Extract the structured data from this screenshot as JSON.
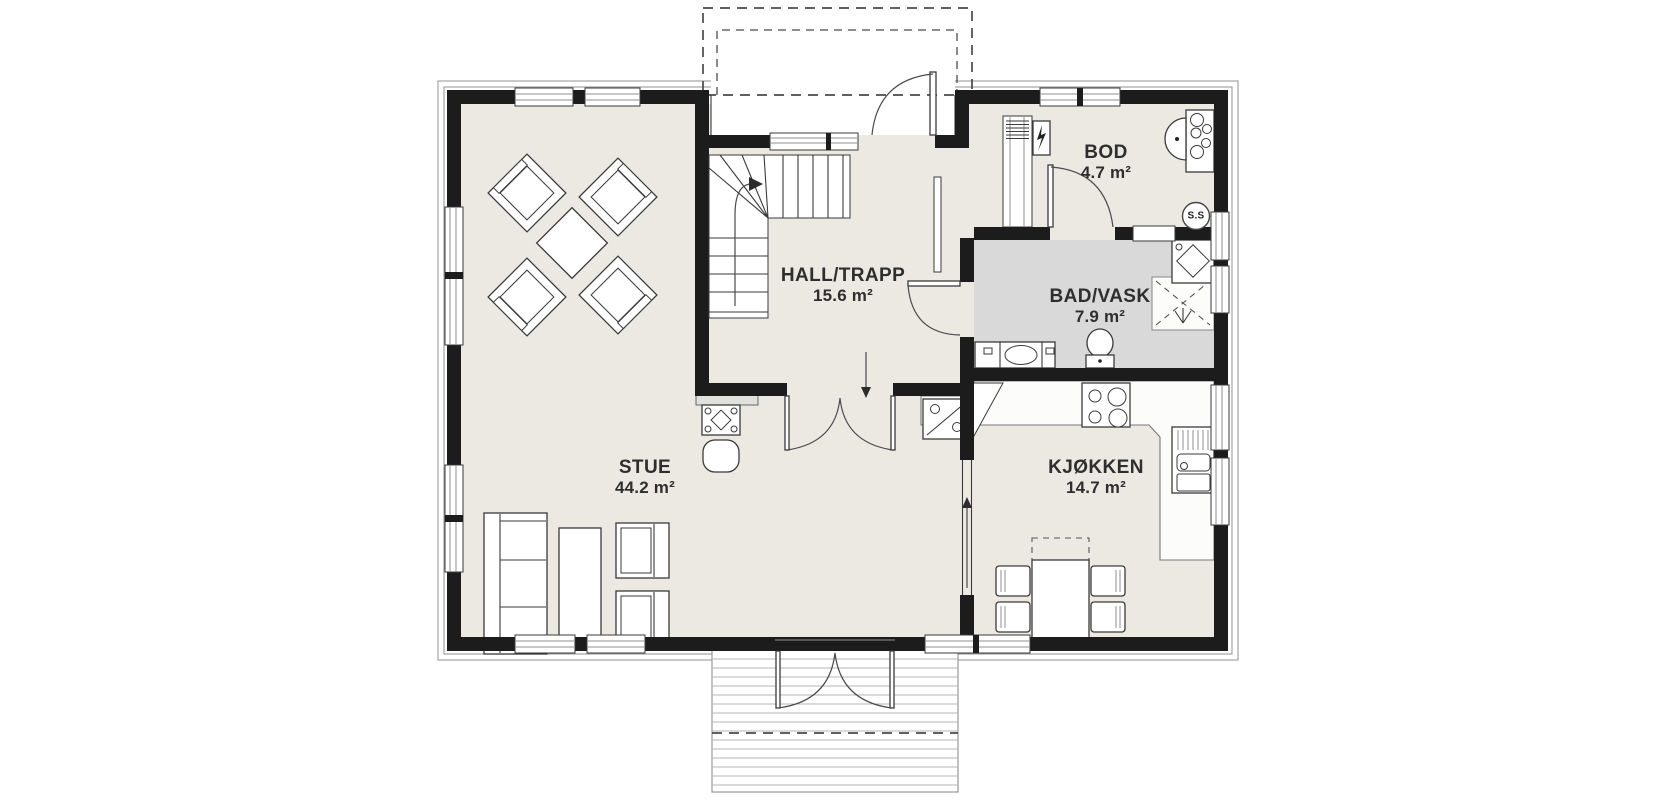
{
  "page": {
    "background": "#ffffff",
    "type": "architectural-floor-plan",
    "language": "Norwegian"
  },
  "palette": {
    "wall": "#1c1c1c",
    "floor": "#ebe9e2",
    "bathroom_floor": "#d9d9da",
    "outline": "#3a3a3a",
    "terrace_line": "#b5b5b5"
  },
  "rooms": {
    "stue": {
      "name": "STUE",
      "area": "44.2 m²"
    },
    "hall": {
      "name": "HALL/TRAPP",
      "area": "15.6 m²"
    },
    "bod": {
      "name": "BOD",
      "area": "4.7 m²"
    },
    "bad_vask": {
      "name": "BAD/VASK",
      "area": "7.9 m²"
    },
    "kjokken": {
      "name": "KJØKKEN",
      "area": "14.7 m²"
    }
  },
  "badges": {
    "ss": "S.S"
  },
  "fixtures": {
    "stue": [
      "diagonal-seating-group",
      "fireplace-stove",
      "sofa",
      "coffee-table",
      "armchairs"
    ],
    "hall": [
      "l-shaped-staircase",
      "double-doors-to-stue",
      "thin-partition"
    ],
    "bod": [
      "electrical-panel",
      "vent-shaft",
      "water-heater-unit"
    ],
    "bad_vask": [
      "vanity-sink",
      "toilet",
      "shower-corner",
      "washing-machine"
    ],
    "kjokken": [
      "dishwasher",
      "cooktop",
      "kitchen-sink",
      "dining-table-with-chairs"
    ],
    "exterior": [
      "entrance-porch",
      "terrace"
    ]
  }
}
